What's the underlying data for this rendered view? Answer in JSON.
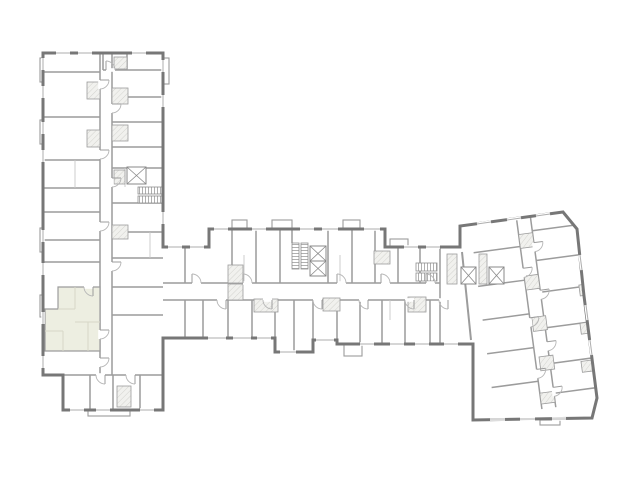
{
  "app": {
    "type": "architectural-floor-plan",
    "view": "single-storey-plan"
  },
  "canvas": {
    "width": 640,
    "height": 480
  },
  "palette": {
    "background": "#ffffff",
    "outer_wall": "#777777",
    "inner_wall": "#9c9c9c",
    "partition": "#c7c7c7",
    "window_line": "#aeaeae",
    "door_arc": "#b6b6b6",
    "hatch_fill": "#f1f1ee",
    "hatch_line": "#c6c6c2",
    "stair_line": "#8e8e8e",
    "elevator_line": "#8a8a8a",
    "balcony_line": "#9c9c9c",
    "highlight_fill": "#edeee1",
    "highlight_line": "#d7d7c6"
  },
  "plan": {
    "wings": [
      {
        "id": "left-wing",
        "orientation": "vertical"
      },
      {
        "id": "central-wing",
        "orientation": "horizontal"
      },
      {
        "id": "right-wing",
        "orientation": "angled"
      }
    ],
    "highlighted_unit": {
      "wing": "left-wing",
      "position": "south-west",
      "selected": true
    },
    "stair_cores": 3,
    "elevator_shafts": 5
  }
}
